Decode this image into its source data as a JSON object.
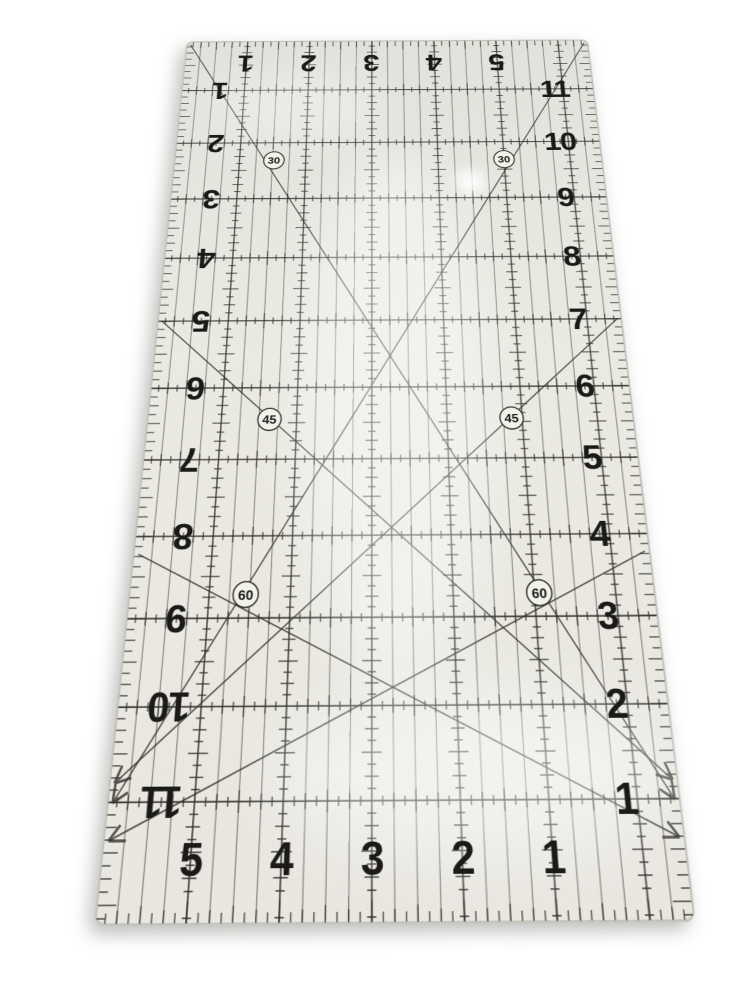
{
  "scene": {
    "background_color": "#ffffff"
  },
  "ruler": {
    "body_color": "#f2f1ea",
    "body_color_top": "#e9e8e2",
    "edge_color": "#c7c6bf",
    "line_color": "#33312c",
    "number_color": "#1b1a18",
    "width_inches": 6.5,
    "length_inches": 12.2,
    "top_numbers": [
      "1",
      "2",
      "3",
      "4",
      "5"
    ],
    "bottom_numbers": [
      "5",
      "4",
      "3",
      "2",
      "1"
    ],
    "left_numbers": [
      "1",
      "2",
      "3",
      "4",
      "5",
      "6",
      "7",
      "8",
      "9",
      "10",
      "11"
    ],
    "right_numbers": [
      "11",
      "10",
      "9",
      "8",
      "7",
      "6",
      "5",
      "4",
      "3",
      "2",
      "1"
    ],
    "angle_markings": [
      {
        "label": "30",
        "x_in": 1.52,
        "y_in": 2.32
      },
      {
        "label": "30",
        "x_in": 5.0,
        "y_in": 2.32
      },
      {
        "label": "45",
        "x_in": 1.64,
        "y_in": 6.45
      },
      {
        "label": "45",
        "x_in": 4.86,
        "y_in": 6.45
      },
      {
        "label": "60",
        "x_in": 1.45,
        "y_in": 8.72
      },
      {
        "label": "60",
        "x_in": 5.06,
        "y_in": 8.72
      }
    ]
  }
}
